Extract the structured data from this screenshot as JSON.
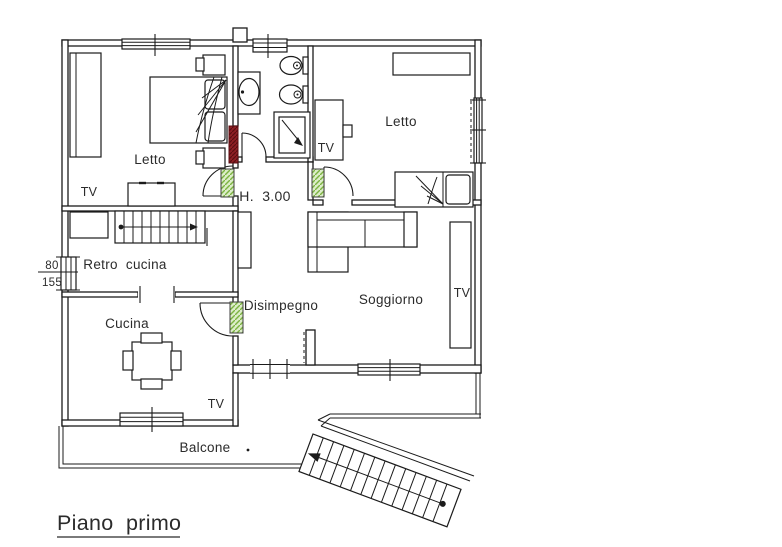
{
  "plan": {
    "title": "Piano  primo",
    "rooms": {
      "letto1": {
        "label": "Letto",
        "tv_label": "TV"
      },
      "letto2": {
        "label": "Letto",
        "tv_label": "TV"
      },
      "retro_cucina": {
        "label": "Retro  cucina"
      },
      "cucina": {
        "label": "Cucina",
        "tv_label": "TV"
      },
      "disimpegno": {
        "label": "Disimpegno"
      },
      "soggiorno": {
        "label": "Soggiorno",
        "tv_label": "TV"
      },
      "balcone": {
        "label": "Balcone"
      }
    },
    "annotations": {
      "ceiling_height": "H.  3.00",
      "window_dim_width": "80",
      "window_dim_height": "155"
    },
    "colors": {
      "line": "#1b1b1b",
      "column_fill": "#dcedc8",
      "column_hatch": "#7cb342",
      "new_wall_fill": "#8e1f24",
      "new_wall_hatch": "#5a0e12"
    }
  }
}
